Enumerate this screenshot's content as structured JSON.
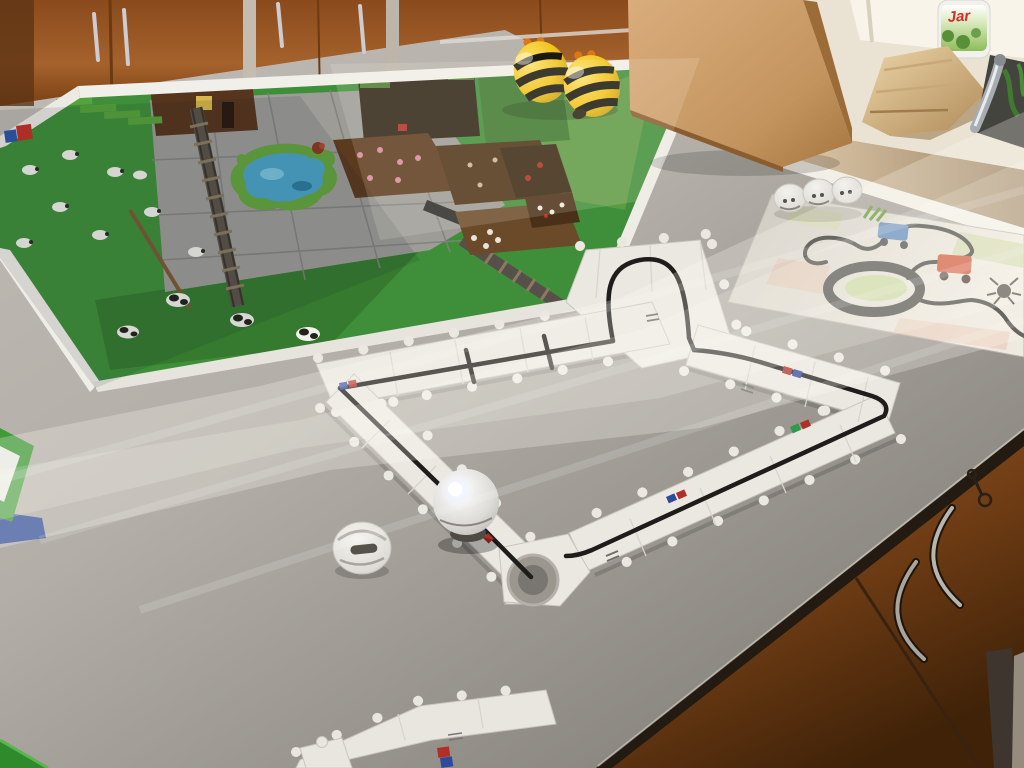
{
  "scene": {
    "type": "photograph",
    "description": "Classroom table with educational robotics: an Ozobot line-following puzzle track, Bee-Bot robots, a Minecraft-themed activity mat and a hand-drawn marker track map",
    "setting": "classroom with wooden cabinets, a sink counter and diagonal sunlight bands on a grey countertop"
  },
  "objects": {
    "upper_cabinets": {
      "label": "wooden wall cabinets",
      "color": "#93521f"
    },
    "sink_counter": {
      "label": "sink counter with chrome faucet",
      "color": "#e9e2d3"
    },
    "jar_bottle": {
      "label": "dish soap bottle",
      "brand_text": "Jar",
      "label_color": "#8fbc5a"
    },
    "towel": {
      "label": "beige cloth by the sink",
      "color": "#d8b887"
    },
    "wooden_box": {
      "label": "beech wood box standing on the table",
      "color": "#cb9c69"
    },
    "beebots": {
      "label": "two Bee-Bot robots",
      "count": 2,
      "body_color": "#f2c31c",
      "stripe_color": "#1c1910"
    },
    "minecraft_mat": {
      "label": "Minecraft-style activity mat",
      "grass_color": "#3f8f3a",
      "stone_color": "#9d9c97",
      "pond_color": "#4aa3c6"
    },
    "puzzle_track": {
      "label": "Ozobot puzzle line track",
      "piece_color": "#ebe8e2",
      "line_color": "#1e1d1b",
      "code_colors": [
        "#b03028",
        "#2e4a9c",
        "#2f9a4c"
      ]
    },
    "ozobot": {
      "label": "Ozobot robot with lit white LED",
      "body_color": "#e3e2df"
    },
    "ozobot_skin_single": {
      "label": "white Ozobot shell on the table"
    },
    "ozobot_skins_row": {
      "label": "three white Ozobot shells in a row",
      "count": 3
    },
    "drawn_map": {
      "label": "hand-drawn track map with roundabout and tractors",
      "paper_color": "#e6e1d7"
    },
    "loose_pieces": {
      "label": "loose puzzle pieces at table edge"
    },
    "green_box": {
      "label": "green box at left table edge",
      "color": "#3f9a38"
    },
    "lower_cabinets": {
      "label": "under-counter cabinet with curved handles and a key",
      "color": "#7c4314"
    },
    "table": {
      "label": "light grey countertop",
      "color": "#b7b3ac"
    },
    "floor": {
      "label": "grey floor in bottom-right corner",
      "color": "#968b7f"
    }
  },
  "lighting": {
    "description": "diagonal window sunlight band crossing the table",
    "highlight": "#fffdf4"
  }
}
